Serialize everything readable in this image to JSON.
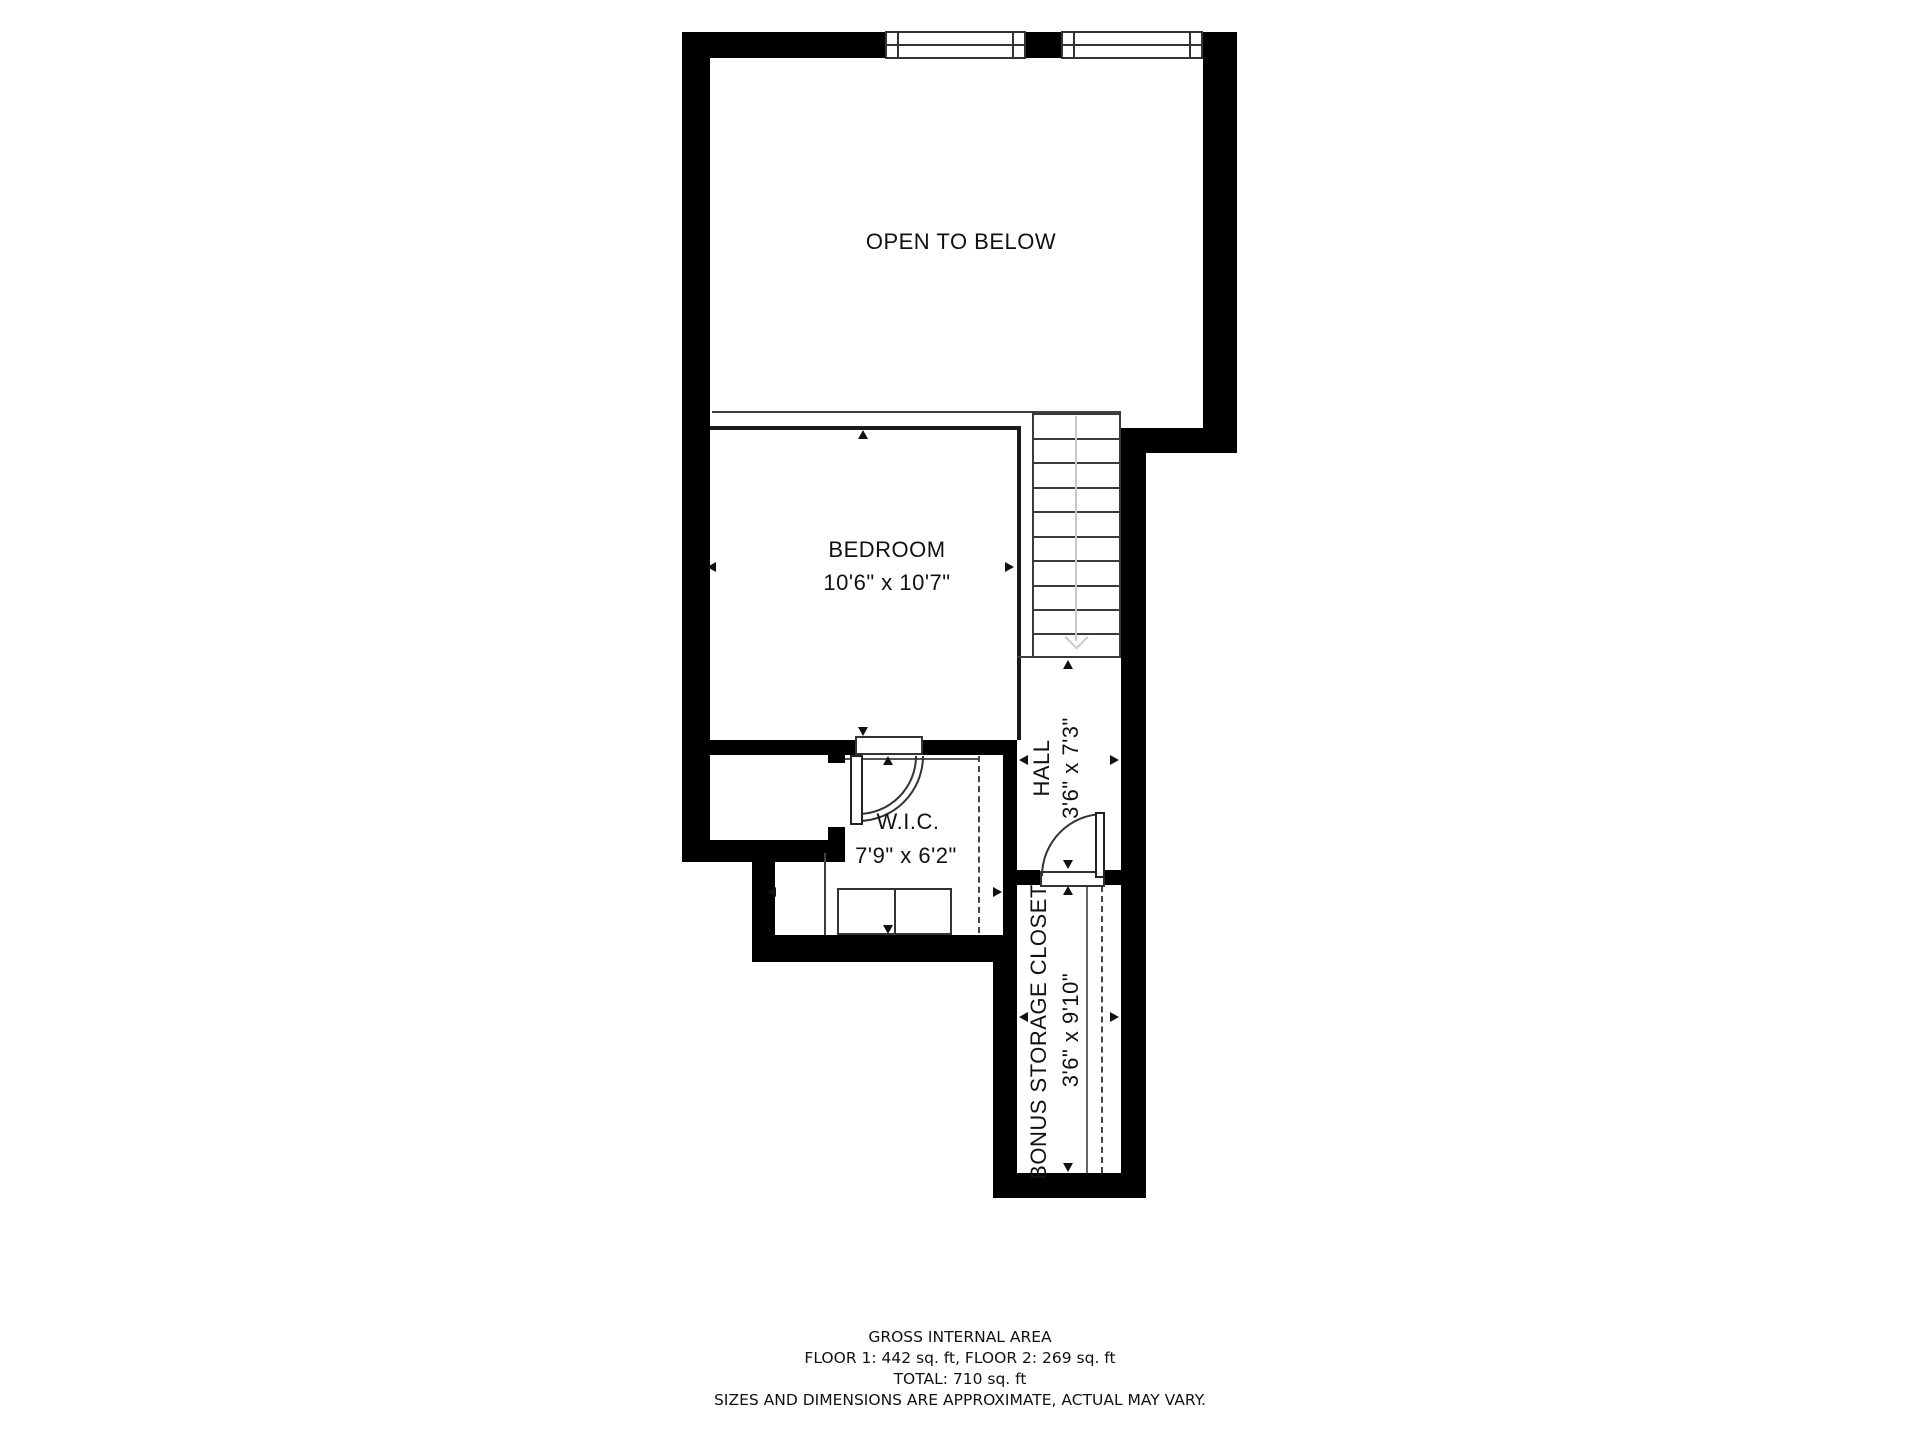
{
  "rooms": {
    "open_below": {
      "label": "OPEN TO BELOW"
    },
    "bedroom": {
      "label": "BEDROOM",
      "dims": "10'6\" x 10'7\""
    },
    "wic": {
      "label": "W.I.C.",
      "dims": "7'9\" x 6'2\""
    },
    "hall": {
      "label": "HALL",
      "dims": "3'6\" x 7'3\""
    },
    "storage": {
      "label": "BONUS STORAGE CLOSET",
      "dims": "3'6\" x 9'10\""
    }
  },
  "footer": {
    "line1": "GROSS INTERNAL AREA",
    "line2": "FLOOR 1: 442 sq. ft, FLOOR 2: 269 sq. ft",
    "line3": "TOTAL: 710 sq. ft",
    "line4": "SIZES AND DIMENSIONS ARE APPROXIMATE, ACTUAL MAY VARY."
  },
  "colors": {
    "wall": "#000000",
    "thin_line": "#3f3f3f",
    "background": "#ffffff",
    "stairs_arrow": "#c9c9c9"
  },
  "icons": {
    "dimension-arrow": "css-triangle",
    "stairs-direction-arrow": "css-chevron-down"
  }
}
